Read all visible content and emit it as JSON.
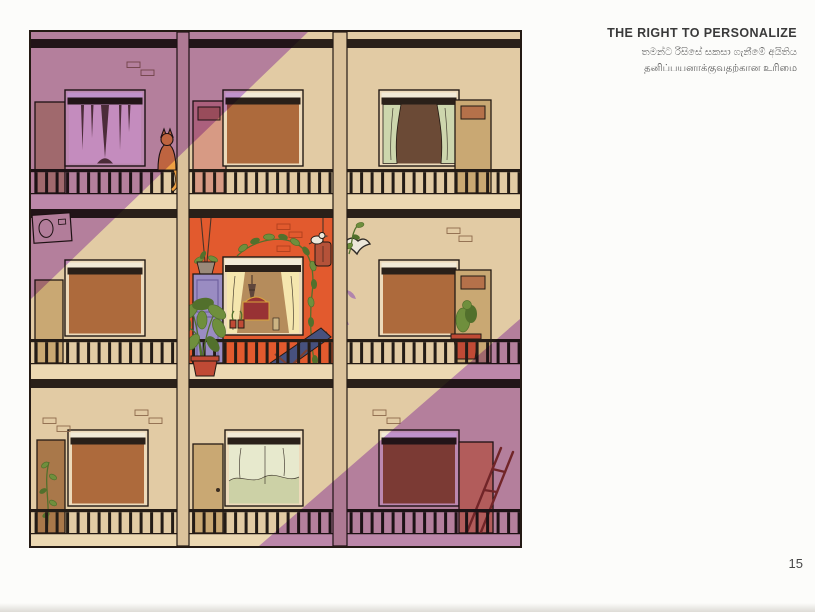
{
  "page": {
    "background": "#fcfcfa",
    "number": "15"
  },
  "heading": {
    "title": "THE RIGHT TO PERSONALIZE",
    "subtitle_sinhala": "තමන්ට රිසිසේ සකසා ගැනීමේ අයිතිය",
    "subtitle_tamil": "தனிப்பயனாக்குவதற்கான உரிமை"
  },
  "illustration": {
    "colors": {
      "lineDark": "#241a14",
      "stripeDark": "#2a2019",
      "railDark": "#241c16",
      "wallCream": "#e2cba4",
      "slabLight": "#ecd8b2",
      "dividerCream": "#dbc29b",
      "frameLight": "#eddaba",
      "frameTop": "#f2ead7",
      "winPink": "#f6e0c8",
      "curtainDark": "#5f463c",
      "shadeBrown": "#ad6a3c",
      "shadeDark": "#9a5c36",
      "winDark": "#6b4a36",
      "curtainGreen": "#cdd6ad",
      "curtainPale": "#e7e9cd",
      "curtainPaleShade": "#ccd1a6",
      "curtainCream": "#f5e6ae",
      "interiorTan": "#b58c5c",
      "orangeWall": "#e25a2e",
      "doorTan": "#c9a873",
      "doorBrown": "#a9784a",
      "doorPink": "#d79a84",
      "doorPinkPanel": "#c07a60",
      "doorPanelBrown": "#b5714a",
      "doorPurple": "#9a8cc2",
      "doorPurpleLine": "#6f609f",
      "doorSalmon": "#e09360",
      "plantGreen": "#6f8f3d",
      "plantDark": "#52702c",
      "potRed": "#c04a35",
      "catOrange": "#efa143",
      "chairBlue": "#47517e",
      "chairFrame": "#7c4030",
      "lanternRed": "#b55239",
      "ladderRed": "#8e3a2a",
      "birdWhite": "#ece7da",
      "birdDark": "#2f2a26",
      "brickLine": "#8d6a4c",
      "brickOrange": "#b0401f",
      "shrineRed": "#983234",
      "shrineGold": "#d9a43c",
      "bottleTan": "#cdb483",
      "planterPot": "#9a8a7a",
      "purpleMark": "#a06cb0",
      "acBox": "#e0c8a2",
      "shadowMult": "#cb9ff2"
    }
  }
}
